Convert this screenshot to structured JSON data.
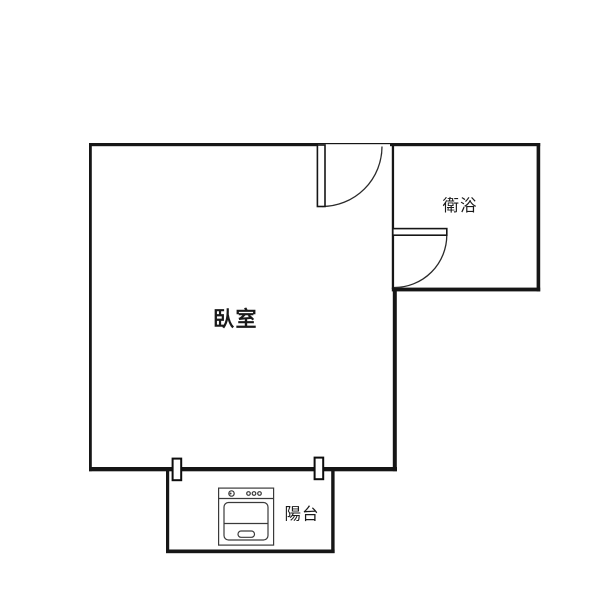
{
  "page": {
    "background_color": "#ffffff",
    "line_color": "#161616"
  },
  "floor_plan": {
    "rooms": {
      "bedroom": {
        "label": "臥室"
      },
      "bathroom": {
        "label": "衛浴"
      },
      "balcony": {
        "label": "陽台"
      }
    },
    "fixtures": [
      {
        "icon": "washing-machine-icon",
        "room": "balcony"
      }
    ],
    "doors": [
      {
        "name": "bedroom-entry-door",
        "type": "swing"
      },
      {
        "name": "bathroom-door",
        "type": "swing"
      }
    ]
  }
}
